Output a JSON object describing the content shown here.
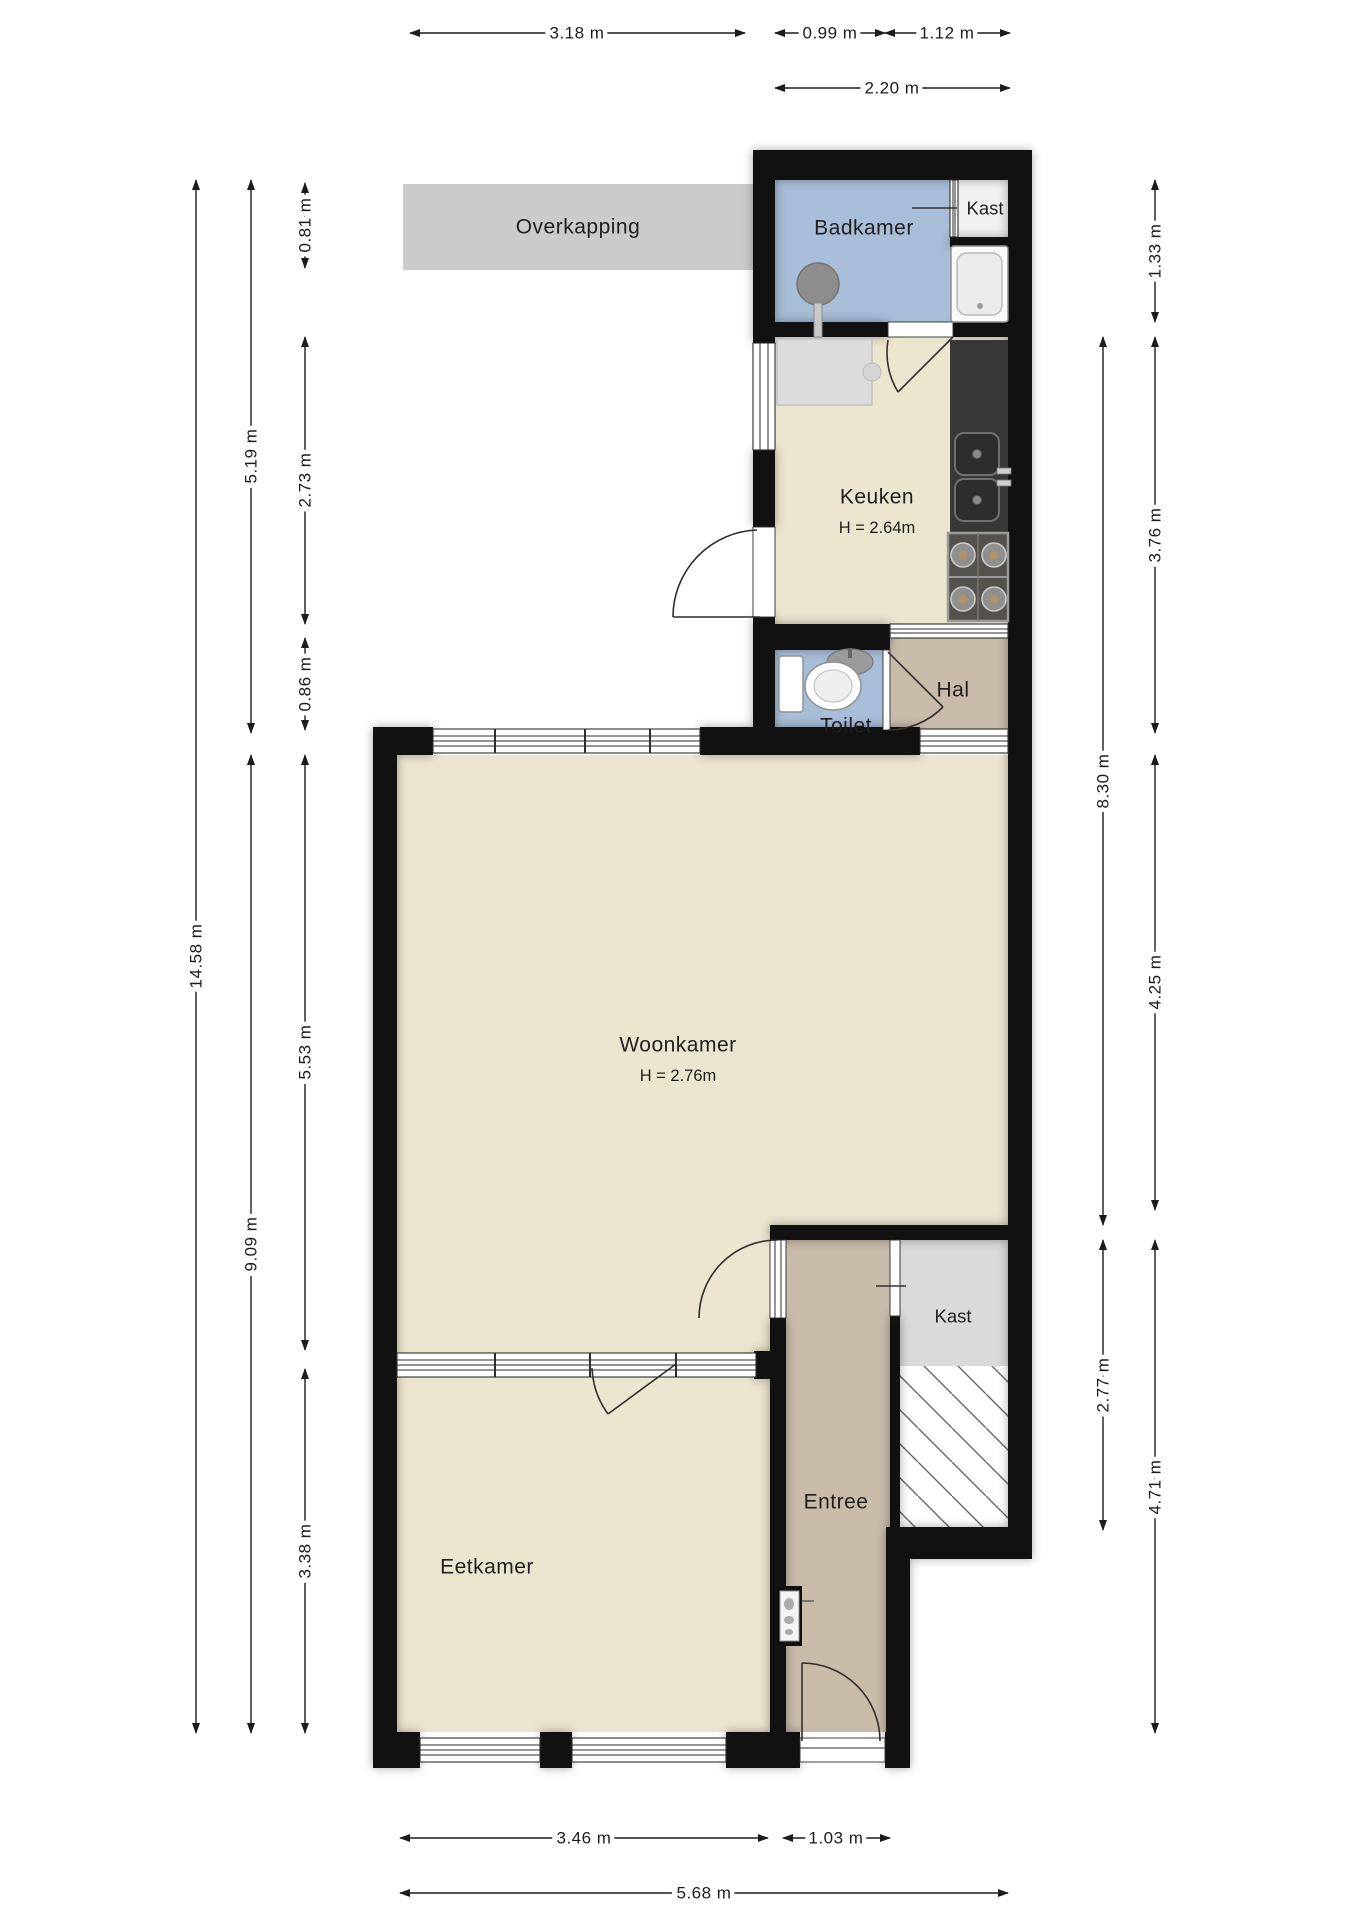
{
  "rooms": {
    "overkapping": {
      "label": "Overkapping"
    },
    "badkamer": {
      "label": "Badkamer"
    },
    "kast_boven": {
      "label": "Kast"
    },
    "keuken": {
      "label": "Keuken",
      "height": "H = 2.64m"
    },
    "toilet": {
      "label": "Toilet"
    },
    "hal": {
      "label": "Hal"
    },
    "woonkamer": {
      "label": "Woonkamer",
      "height": "H = 2.76m"
    },
    "kast_onder": {
      "label": "Kast"
    },
    "entree": {
      "label": "Entree"
    },
    "eetkamer": {
      "label": "Eetkamer"
    }
  },
  "dims": {
    "top": {
      "d318": {
        "label": "3.18 m"
      },
      "d099": {
        "label": "0.99 m"
      },
      "d112": {
        "label": "1.12 m"
      },
      "d220": {
        "label": "2.20 m"
      }
    },
    "bottom": {
      "d346": {
        "label": "3.46 m"
      },
      "d103": {
        "label": "1.03 m"
      },
      "d568": {
        "label": "5.68 m"
      }
    },
    "left": {
      "d081": {
        "label": "0.81 m"
      },
      "d519": {
        "label": "5.19 m"
      },
      "d273": {
        "label": "2.73 m"
      },
      "d086": {
        "label": "0.86 m"
      },
      "d1458": {
        "label": "14.58 m"
      },
      "d553": {
        "label": "5.53 m"
      },
      "d909": {
        "label": "9.09 m"
      },
      "d338": {
        "label": "3.38 m"
      }
    },
    "right": {
      "d133": {
        "label": "1.33 m"
      },
      "d376": {
        "label": "3.76 m"
      },
      "d830": {
        "label": "8.30 m"
      },
      "d425": {
        "label": "4.25 m"
      },
      "d277": {
        "label": "2.77 m"
      },
      "d471": {
        "label": "4.71 m"
      }
    }
  },
  "colors": {
    "wall": "#111111",
    "beige": "#ebe4ce",
    "blue": "#a8bdd8",
    "tan": "#c8bbaa",
    "overkapping": "#cbcbcb",
    "kast_gray": "#dadada",
    "kast_white": "#f1f1f1",
    "counter": "#383838"
  }
}
